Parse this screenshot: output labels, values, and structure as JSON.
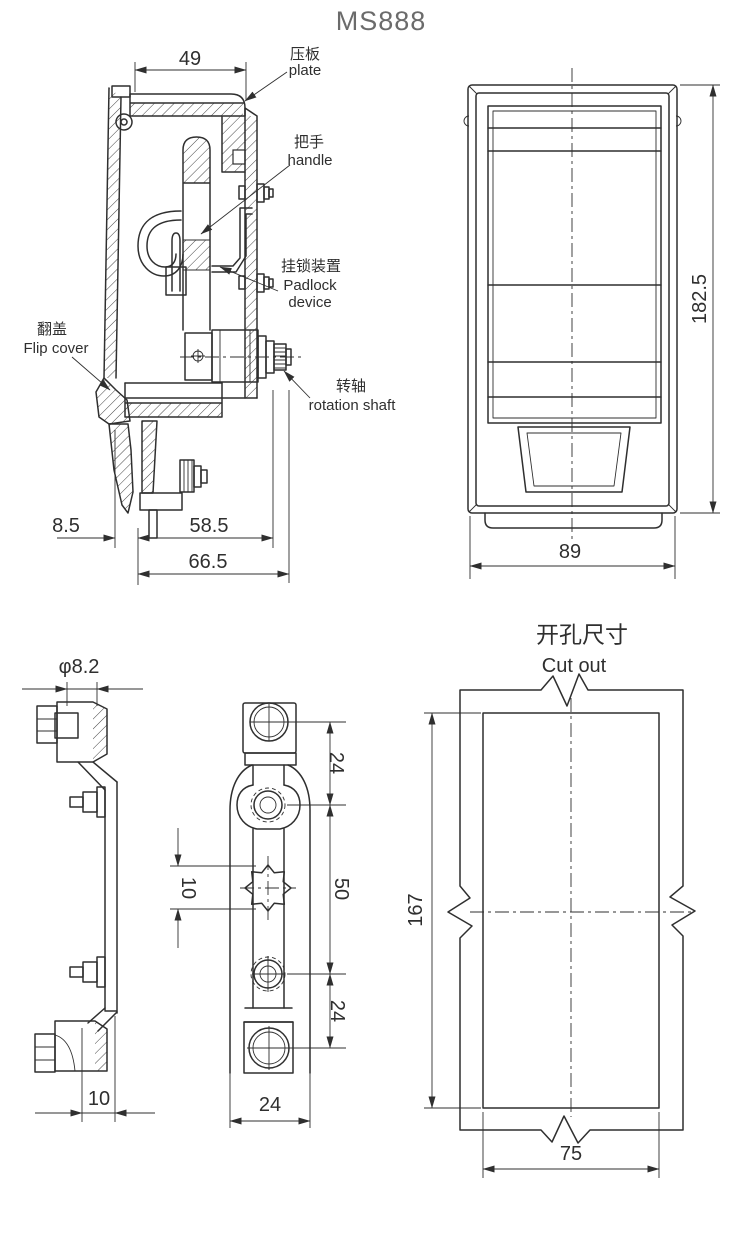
{
  "title": "MS888",
  "colors": {
    "line": "#2f2f2f",
    "title_text": "#6b6b6b",
    "label_text": "#2f2f2f",
    "background": "#ffffff"
  },
  "side_view": {
    "labels": {
      "plate_zh": "压板",
      "plate_en": "plate",
      "handle_zh": "把手",
      "handle_en": "handle",
      "padlock_zh": "挂锁装置",
      "padlock_en_line1": "Padlock",
      "padlock_en_line2": "device",
      "flip_cover_zh": "翻盖",
      "flip_cover_en": "Flip cover",
      "rotation_shaft_zh": "转轴",
      "rotation_shaft_en": "rotation shaft"
    },
    "dims": {
      "plate_width": "49",
      "cover_offset": "8.5",
      "mid_depth": "58.5",
      "overall_depth": "66.5"
    }
  },
  "front_view": {
    "dims": {
      "height": "182.5",
      "width": "89"
    }
  },
  "profile_view": {
    "dims": {
      "shaft_diameter": "φ8.2",
      "cam_offset": "10"
    }
  },
  "rear_view": {
    "dims": {
      "top_spacing": "24",
      "center_spacing": "50",
      "bottom_spacing": "24",
      "square_hole": "10",
      "body_width": "24"
    }
  },
  "cutout_view": {
    "title_zh": "开孔尺寸",
    "title_en": "Cut out",
    "dims": {
      "height": "167",
      "width": "75"
    }
  }
}
